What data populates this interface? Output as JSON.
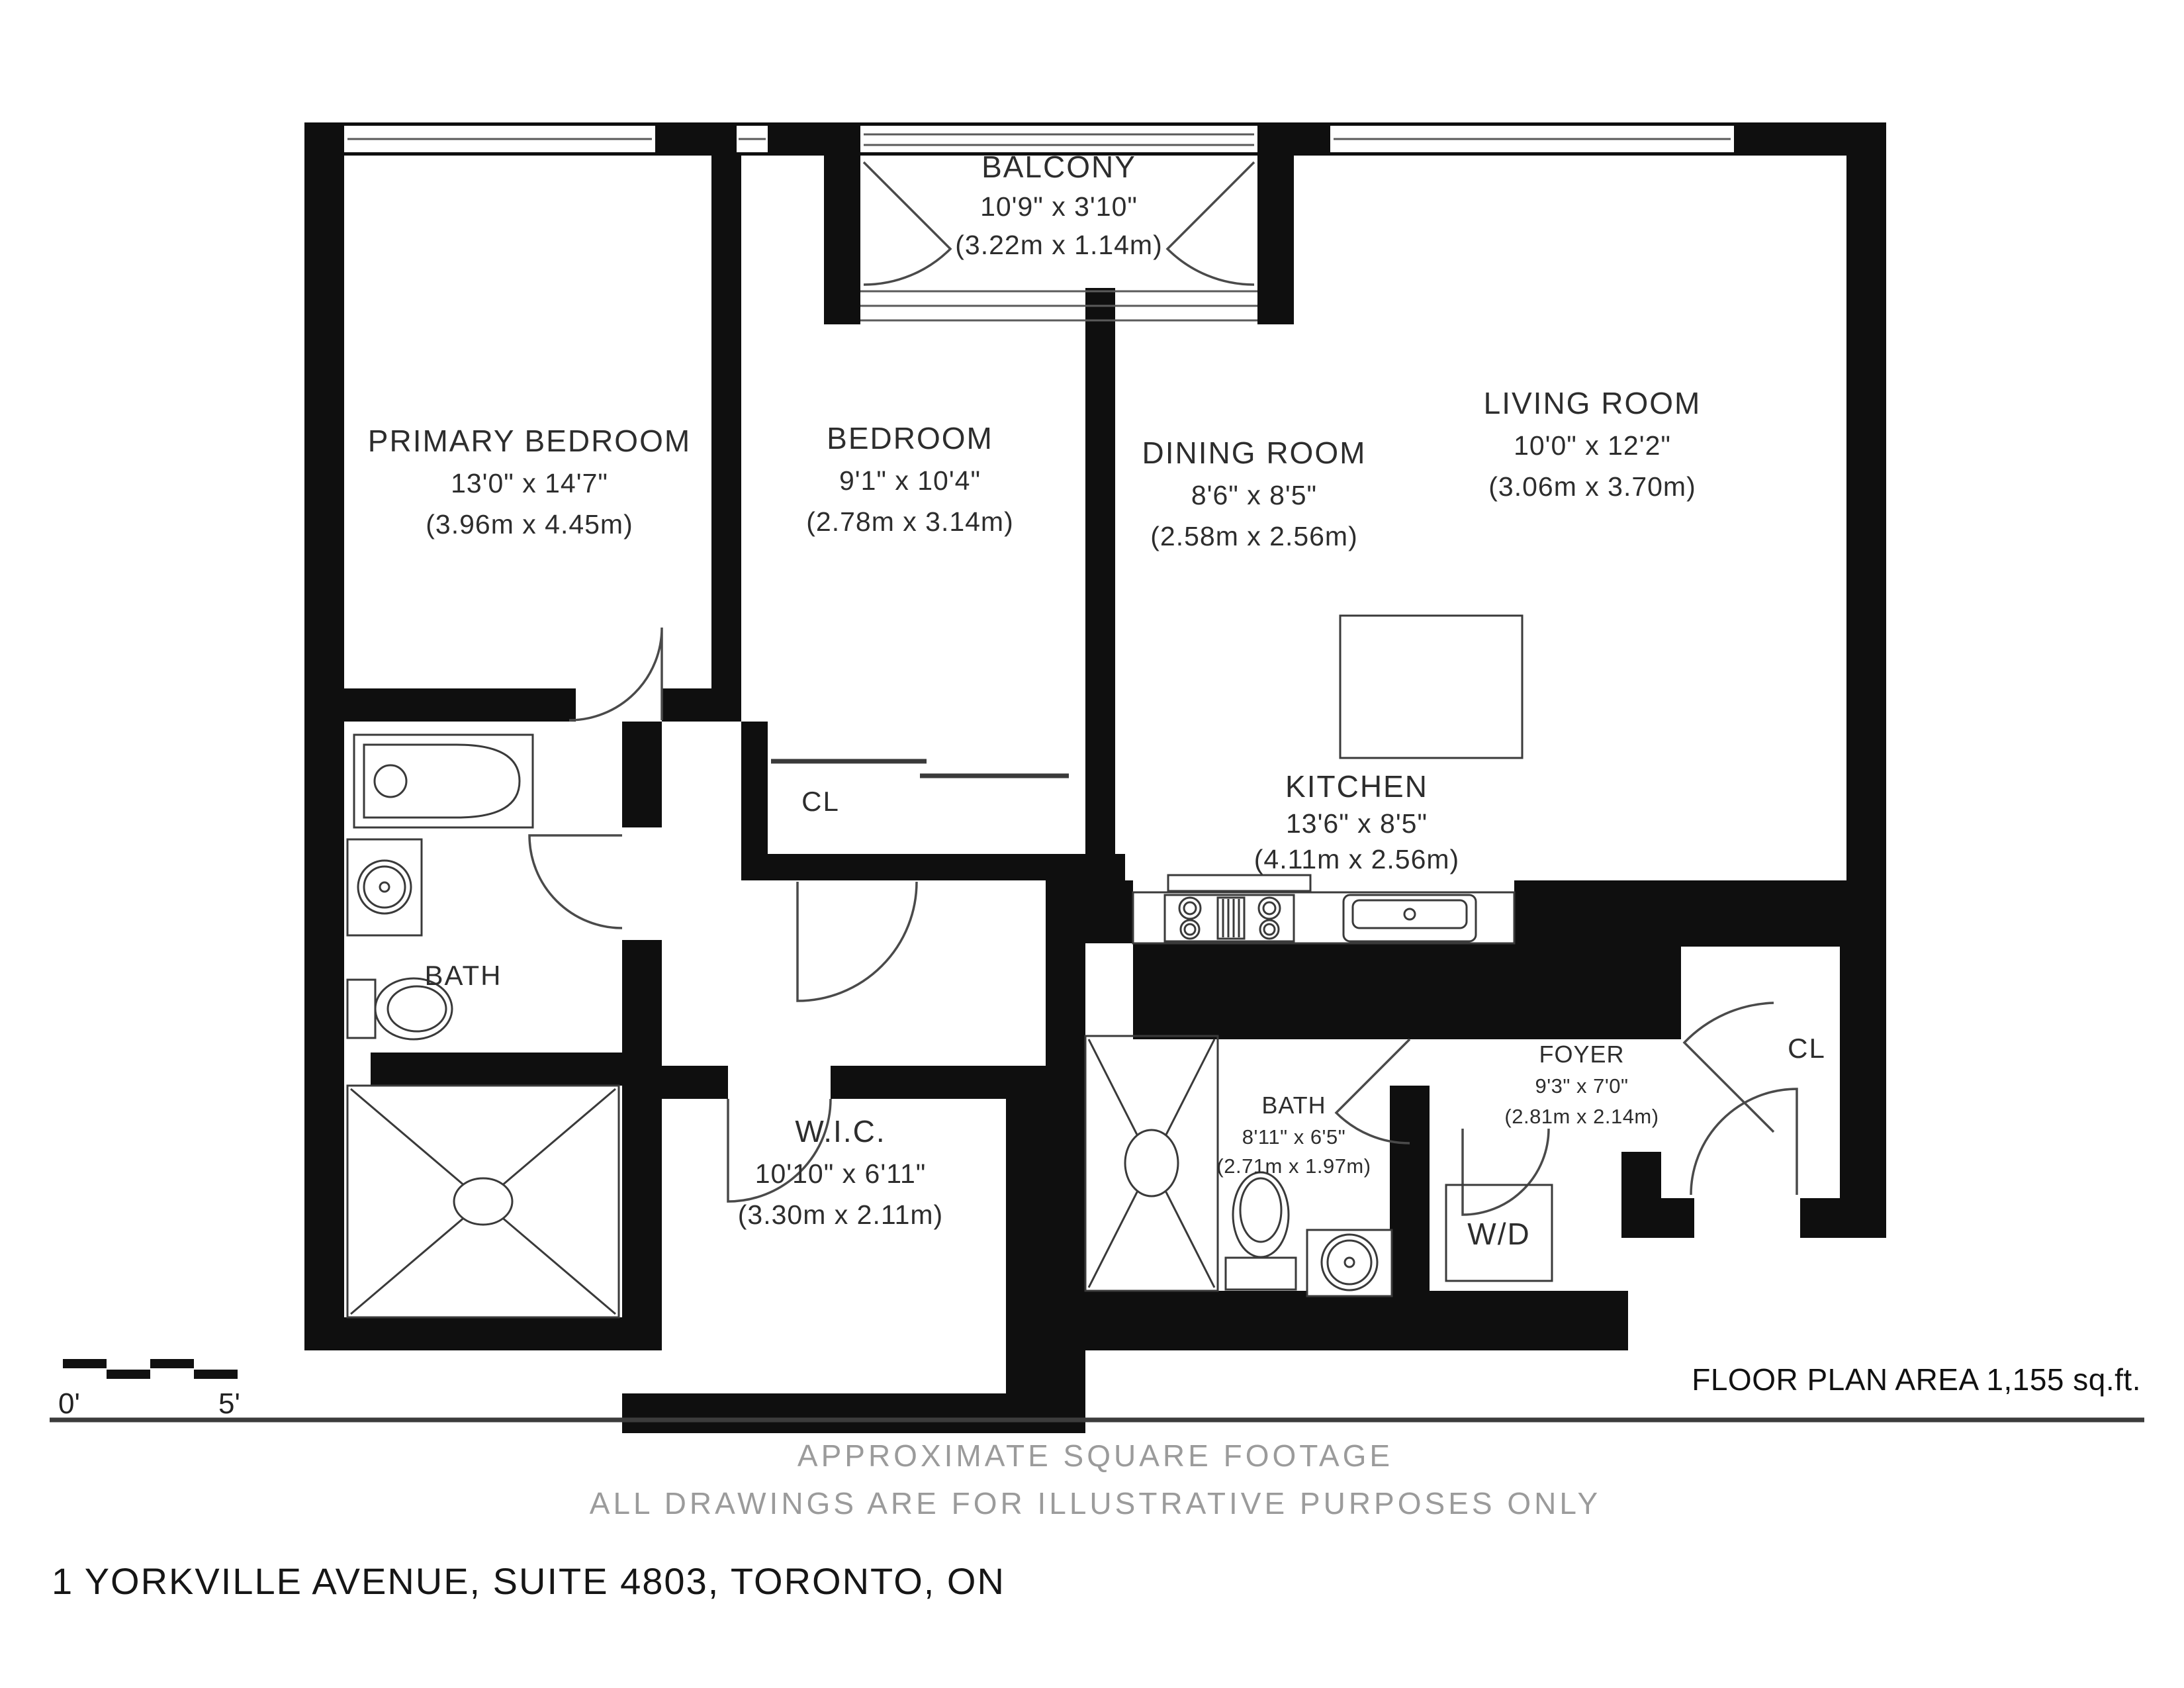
{
  "rooms": {
    "primary_bedroom": {
      "name": "PRIMARY BEDROOM",
      "imperial": "13'0\" x 14'7\"",
      "metric": "(3.96m x 4.45m)"
    },
    "bedroom": {
      "name": "BEDROOM",
      "imperial": "9'1\" x 10'4\"",
      "metric": "(2.78m x 3.14m)"
    },
    "dining_room": {
      "name": "DINING ROOM",
      "imperial": "8'6\" x 8'5\"",
      "metric": "(2.58m x 2.56m)"
    },
    "living_room": {
      "name": "LIVING ROOM",
      "imperial": "10'0\" x 12'2\"",
      "metric": "(3.06m x 3.70m)"
    },
    "balcony": {
      "name": "BALCONY",
      "imperial": "10'9\" x 3'10\"",
      "metric": "(3.22m x 1.14m)"
    },
    "kitchen": {
      "name": "KITCHEN",
      "imperial": "13'6\" x 8'5\"",
      "metric": "(4.11m x 2.56m)"
    },
    "wic": {
      "name": "W.I.C.",
      "imperial": "10'10\" x 6'11\"",
      "metric": "(3.30m x 2.11m)"
    },
    "bath_primary": {
      "name": "BATH"
    },
    "bath_second": {
      "name": "BATH",
      "imperial": "8'11\" x 6'5\"",
      "metric": "(2.71m x 1.97m)"
    },
    "foyer": {
      "name": "FOYER",
      "imperial": "9'3\" x 7'0\"",
      "metric": "(2.81m x 2.14m)"
    },
    "closet_bedroom": {
      "label": "CL"
    },
    "closet_foyer": {
      "label": "CL"
    },
    "laundry": {
      "label": "W/D"
    }
  },
  "scale_bar": {
    "start": "0'",
    "end": "5'"
  },
  "footer": {
    "area": "FLOOR PLAN AREA 1,155 sq.ft.",
    "note1": "APPROXIMATE SQUARE FOOTAGE",
    "note2": "ALL DRAWINGS ARE FOR ILLUSTRATIVE PURPOSES ONLY",
    "address": "1 YORKVILLE AVENUE, SUITE 4803, TORONTO, ON"
  }
}
